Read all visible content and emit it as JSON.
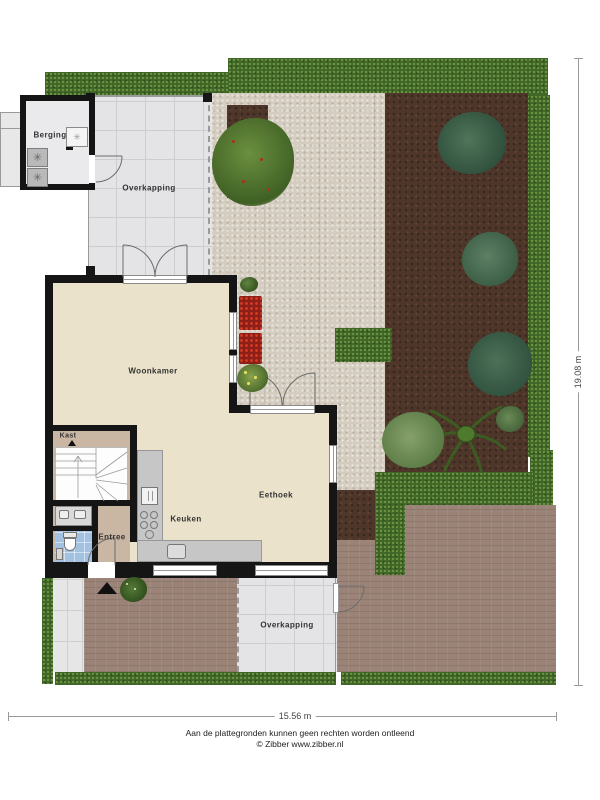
{
  "rooms": {
    "berging": "Berging",
    "overkapping_top": "Overkapping",
    "woonkamer": "Woonkamer",
    "kast": "Kast",
    "entree": "Entree",
    "keuken": "Keuken",
    "eethoek": "Eethoek",
    "overkapping_bottom": "Overkapping"
  },
  "dimensions": {
    "width_label": "15.56 m",
    "height_label": "19.08 m"
  },
  "footer": {
    "disclaimer": "Aan de plattegronden kunnen geen rechten worden ontleend",
    "credit": "© Zibber www.zibber.nl"
  },
  "colors": {
    "hedge": "#3f6527",
    "garden_soil": "#4e372a",
    "stone_path": "#d4ccbe",
    "brick_patio": "#9b8477",
    "wall": "#151515",
    "floor_living": "#eae2cb",
    "floor_entree": "#c9b7a4",
    "floor_overkapping": "#e4e4e6",
    "toilet_floor": "#a3c2e2",
    "kitchen_counter": "#c6c6c6",
    "flowers_red": "#c0301f",
    "accent_plants_teal": "#42685a"
  }
}
